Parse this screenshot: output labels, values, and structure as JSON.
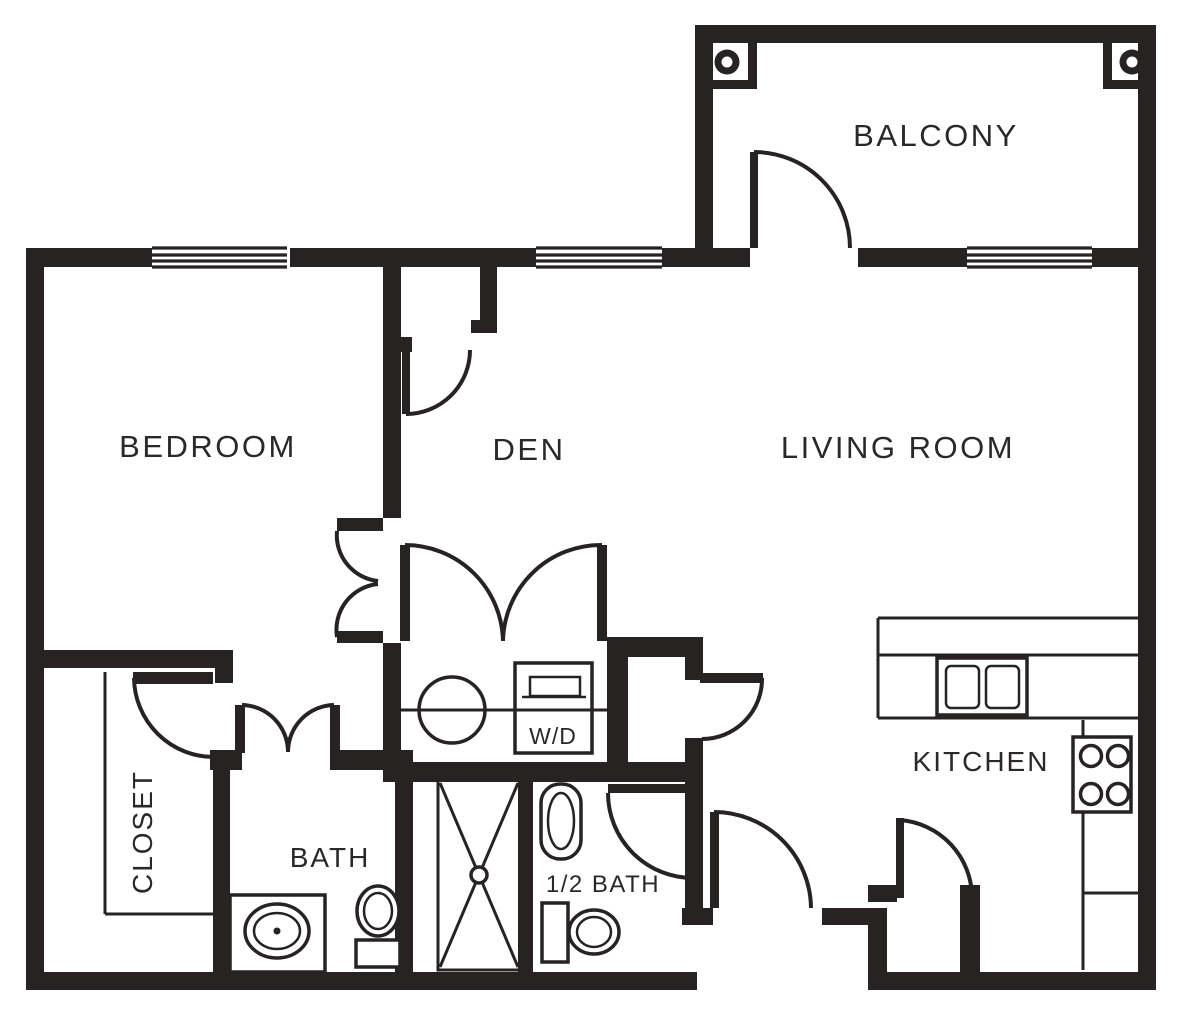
{
  "floorplan": {
    "labels": {
      "balcony": "BALCONY",
      "bedroom": "BEDROOM",
      "den": "DEN",
      "living_room": "LIVING ROOM",
      "kitchen": "KITCHEN",
      "closet": "CLOSET",
      "bath": "BATH",
      "half_bath": "1/2 BATH",
      "washer_dryer": "W/D"
    },
    "colors": {
      "line": "#272322",
      "background": "#ffffff"
    }
  }
}
